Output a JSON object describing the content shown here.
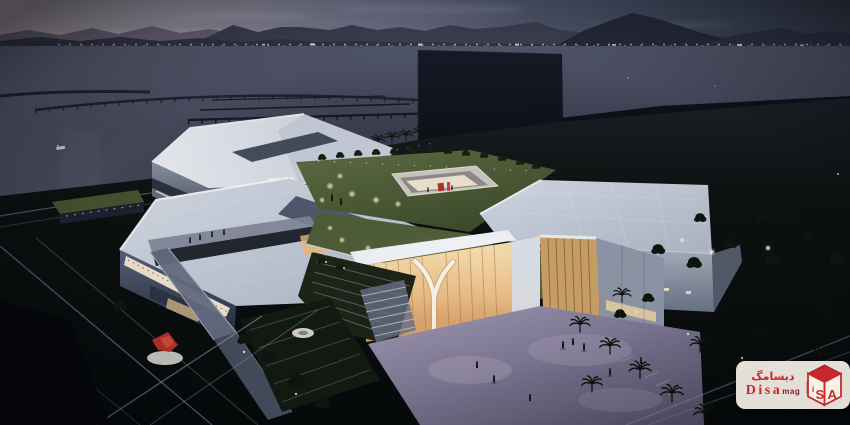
{
  "watermark": {
    "persian_name": "دیسامگ",
    "latin_name": "Disa",
    "latin_suffix": "mag",
    "logo_letters": {
      "i": "i",
      "s": "S",
      "a": "A"
    }
  },
  "palette": {
    "sky_left": "#c0b2b6",
    "sky_right": "#39414f",
    "mountain_far": "#6a6477",
    "mountain_near": "#2a2f3f",
    "sea_top": "#555a6e",
    "sea_bottom": "#262a37",
    "building_white": "#e9ecf2",
    "roof_green": "#5c6a41",
    "glass_warm": "#f7e3bb",
    "plaza_lavender": "#a49bb4",
    "park_dark": "#06090a",
    "brand_red": "#c5292e"
  }
}
